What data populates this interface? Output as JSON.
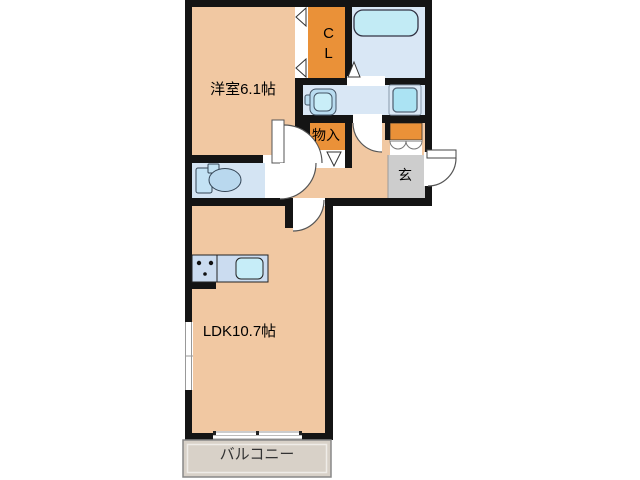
{
  "floorplan": {
    "rooms": {
      "western_room": {
        "label": "洋室6.1帖"
      },
      "closet": {
        "label": "CL"
      },
      "storage": {
        "label": "物入"
      },
      "entrance": {
        "label": "玄"
      },
      "ldk": {
        "label": "LDK10.7帖"
      },
      "balcony": {
        "label": "バルコニー"
      }
    },
    "fixtures": {
      "bathtub": "bathtub-icon",
      "toilet": "toilet-icon",
      "washbasin": "washbasin-icon",
      "washing_machine_pan": "washing-machine-pan-icon",
      "kitchen_sink": "kitchen-sink-icon",
      "stove": "stove-burner-dots-icon"
    },
    "colors": {
      "room_floor": "#f1c8a2",
      "closet_storage_orange": "#ea9138",
      "wet_area_blue": "#d9e7f5",
      "toilet_room_blue": "#d4e4f3",
      "fixture_cyan": "#c2ebf5",
      "entrance_gray": "#cdcdcd",
      "balcony_gray": "#d8d1c8",
      "wall_black": "#141414"
    }
  }
}
